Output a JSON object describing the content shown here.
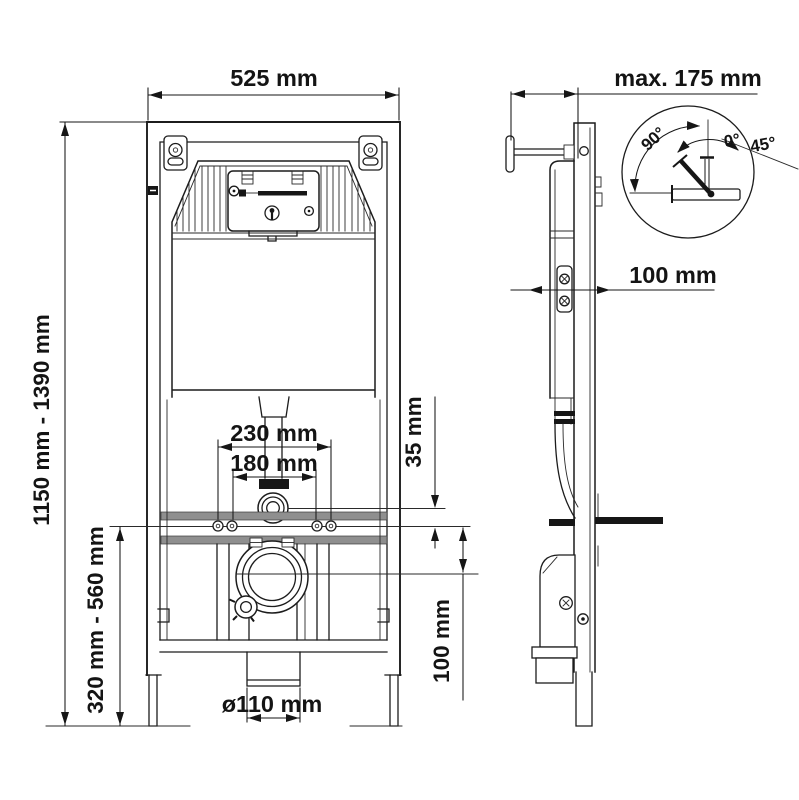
{
  "drawing_title": "wall-mounted wc installation frame dimensions",
  "colors": {
    "line": "#1c1c1c",
    "rail_gray": "#8f8f8f",
    "background": "#ffffff"
  },
  "front_view": {
    "width_label": "525 mm",
    "height_range_label": "1150 mm - 1390 mm",
    "lower_range_label": "320 mm - 560 mm",
    "outer_holes_label": "230 mm",
    "inner_holes_label": "180 mm",
    "supply_offset_label": "35 mm",
    "outlet_offset_label": "100 mm",
    "outlet_diameter_label": "ø110 mm"
  },
  "side_view": {
    "depth_label": "max. 175 mm",
    "front_distance_label": "100 mm",
    "detail": {
      "angle_90": "90°",
      "angle_0": "0°",
      "angle_45": "45°"
    }
  }
}
